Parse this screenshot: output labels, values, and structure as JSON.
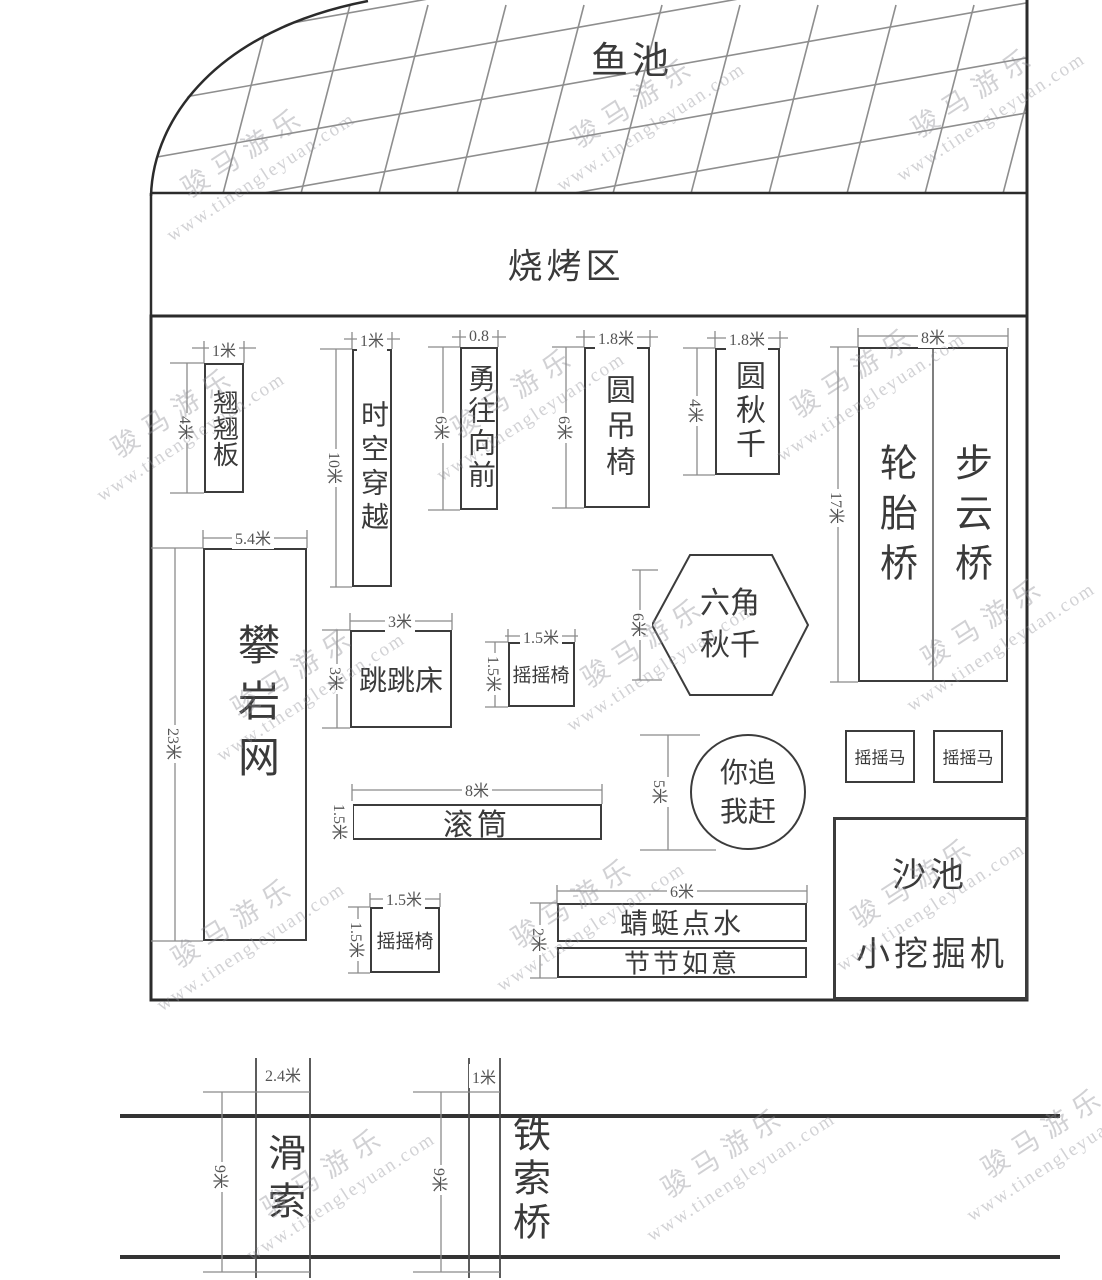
{
  "watermark": {
    "brand": "骏马游乐",
    "site": "www.tinengleyuan.com"
  },
  "zones": {
    "fish_pond": "鱼池",
    "bbq_area": "烧烤区",
    "sand_pit": "沙池",
    "mini_excavator": "小挖掘机"
  },
  "equipment": {
    "seesaw": {
      "label": "翘翘板",
      "w": "1米",
      "h": "4米"
    },
    "time_travel": {
      "label": "时空穿越",
      "w": "1米",
      "h": "10米"
    },
    "forge_ahead": {
      "label": "勇往向前",
      "w": "0.8",
      "h": "6米"
    },
    "round_hanging_chair": {
      "label": "圆吊椅",
      "w": "1.8米",
      "h": "6米"
    },
    "round_swing": {
      "label": "圆秋千",
      "w": "1.8米",
      "h": "4米"
    },
    "tire_bridge": {
      "label": "轮胎桥"
    },
    "cloud_step_bridge": {
      "label": "步云桥"
    },
    "bridges": {
      "w": "8米",
      "h": "17米"
    },
    "climbing_net": {
      "label": "攀岩网",
      "w": "5.4米",
      "h": "23米"
    },
    "trampoline": {
      "label": "跳跳床",
      "w": "3米",
      "h": "3米"
    },
    "rocking_chair_mid": {
      "label": "摇摇椅",
      "w": "1.5米",
      "h": "1.5米"
    },
    "hex_swing": {
      "label": "六角秋千",
      "h": "6米"
    },
    "roller": {
      "label": "滚筒",
      "w": "8米",
      "h": "1.5米"
    },
    "chase_game": {
      "label": "你追我赶",
      "h": "5米"
    },
    "rocking_horse_left": {
      "label": "摇摇马"
    },
    "rocking_horse_right": {
      "label": "摇摇马"
    },
    "rocking_chair_bottom": {
      "label": "摇摇椅",
      "w": "1.5米",
      "h": "1.5米"
    },
    "dragonfly_skimming": {
      "label": "蜻蜓点水",
      "w": "6米",
      "h": "2米"
    },
    "lucky_segments": {
      "label": "节节如意"
    },
    "zipline": {
      "label": "滑索",
      "w": "2.4米",
      "h": "9米"
    },
    "iron_chain_bridge": {
      "label": "铁索桥",
      "w": "1米",
      "h": "9米"
    }
  }
}
